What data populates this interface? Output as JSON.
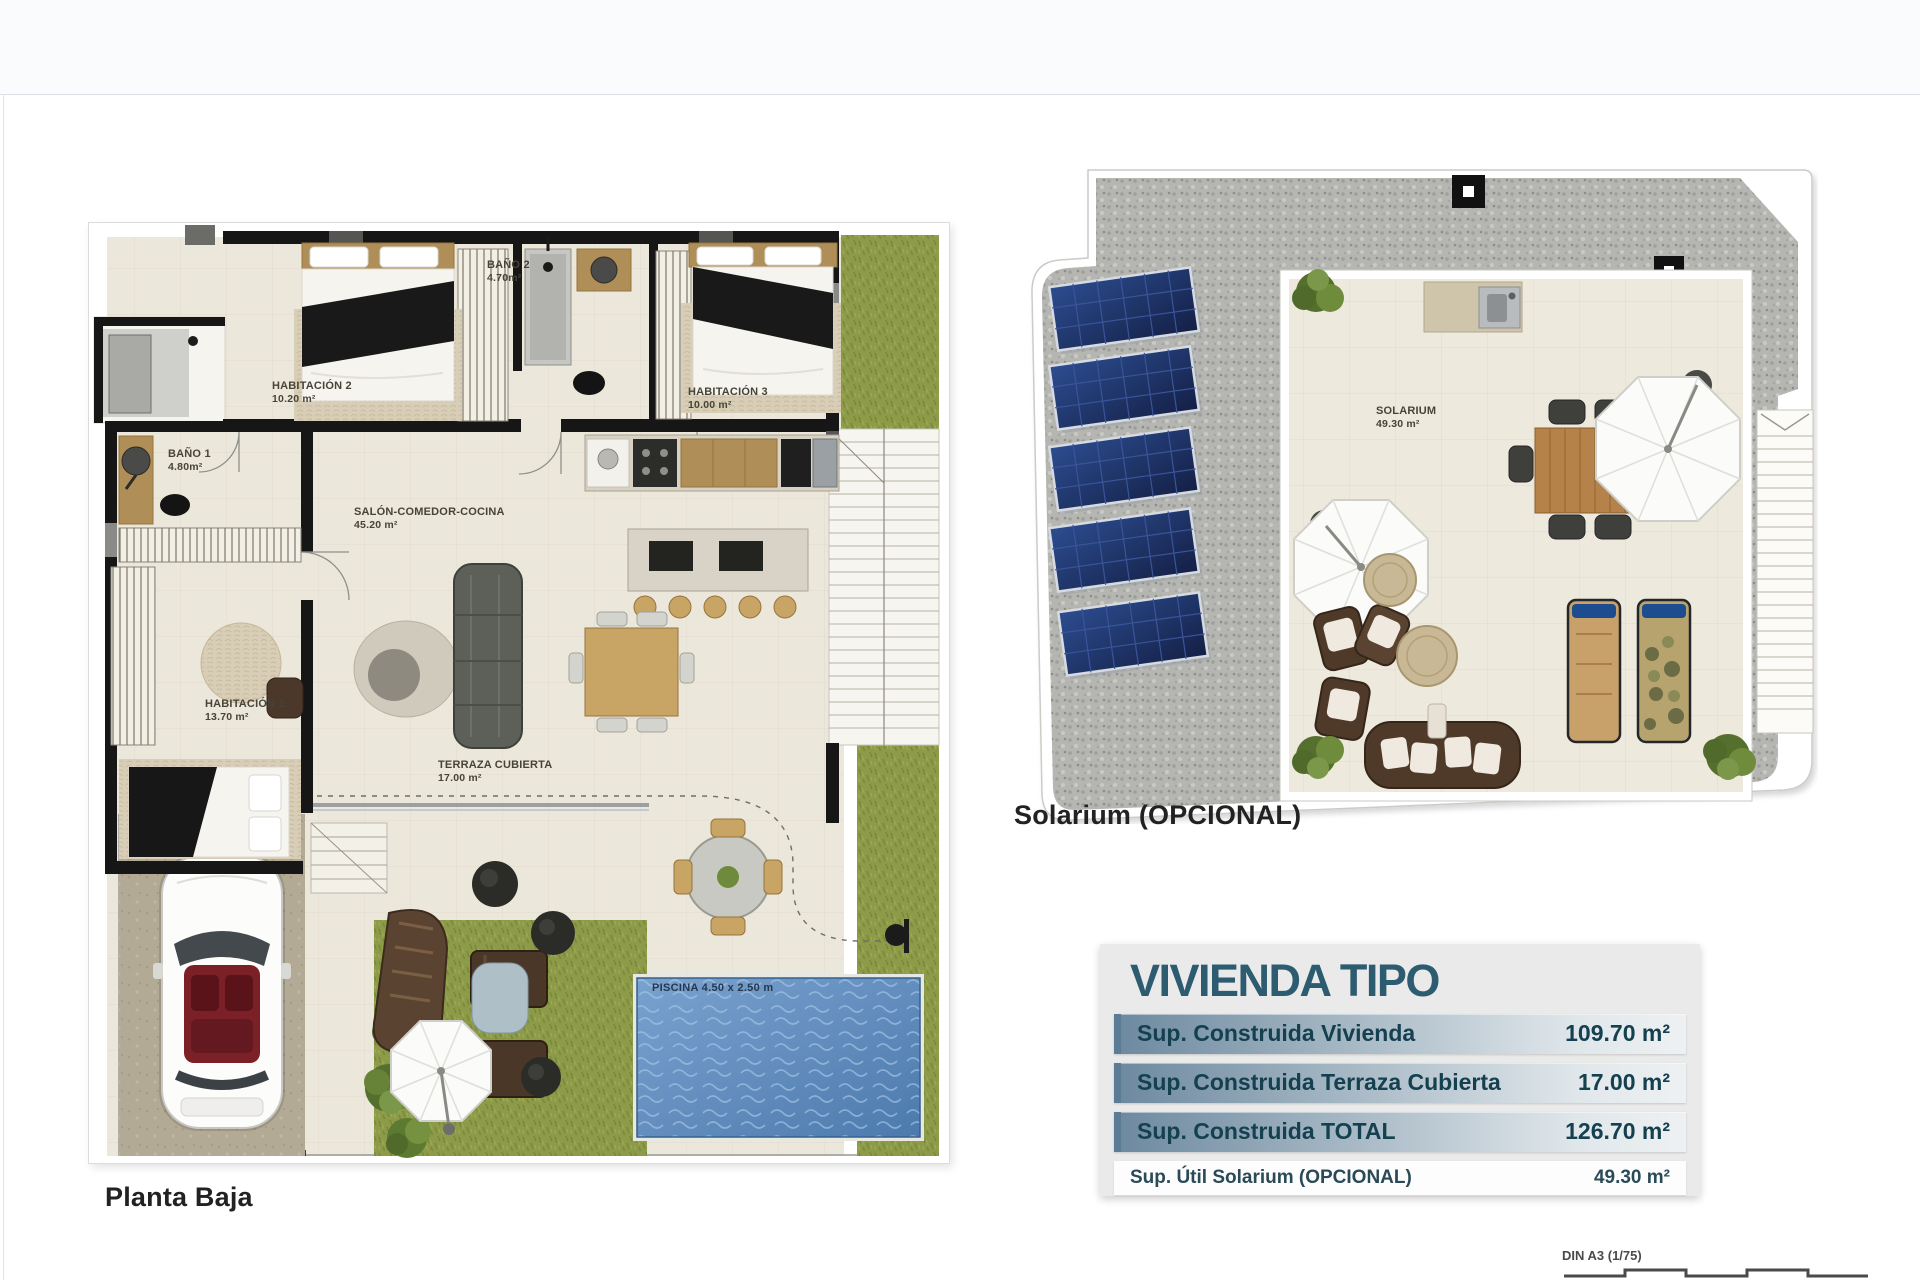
{
  "ground_floor": {
    "caption": "Planta Baja",
    "labels": {
      "hab2_name": "HABITACIÓN 2",
      "hab2_area": "10.20 m²",
      "bano2_name": "BAÑO 2",
      "bano2_area": "4.70m²",
      "hab3_name": "HABITACIÓN 3",
      "hab3_area": "10.00 m²",
      "bano1_name": "BAÑO 1",
      "bano1_area": "4.80m²",
      "hab1_name": "HABITACIÓN 1",
      "hab1_area": "13.70 m²",
      "salon_name": "SALÓN-COMEDOR-COCINA",
      "salon_area": "45.20 m²",
      "terraza_name": "TERRAZA CUBIERTA",
      "terraza_area": "17.00 m²",
      "pool": "PISCINA 4.50 x 2.50 m"
    }
  },
  "solarium": {
    "caption": "Solarium (OPCIONAL)",
    "room_name": "SOLARIUM",
    "room_area": "49.30 m²"
  },
  "summary_table": {
    "title": "VIVIENDA TIPO",
    "rows": [
      {
        "label": "Sup. Construida Vivienda",
        "value": "109.70 m²"
      },
      {
        "label": "Sup. Construida Terraza Cubierta",
        "value": "17.00 m²"
      },
      {
        "label": "Sup. Construida TOTAL",
        "value": "126.70 m²"
      },
      {
        "label": "Sup. Útil Solarium (OPCIONAL)",
        "value": "49.30 m²"
      }
    ]
  },
  "scale_bar": {
    "label": "DIN A3 (1/75)",
    "ticks": [
      "0",
      "1",
      "2",
      "3",
      "4",
      "5"
    ]
  },
  "colors": {
    "accent_teal": "#2d5b70",
    "row_gradient_start": "#6e8aa0",
    "row_gradient_end": "#eef1f3",
    "pool_blue": "#5e8cbe",
    "grass_green": "#8d9a48",
    "gravel_gray": "#b5b5b1",
    "solar_panel_blue": "#23386b",
    "wall_black": "#161616",
    "floor_cream": "#ece7db"
  }
}
